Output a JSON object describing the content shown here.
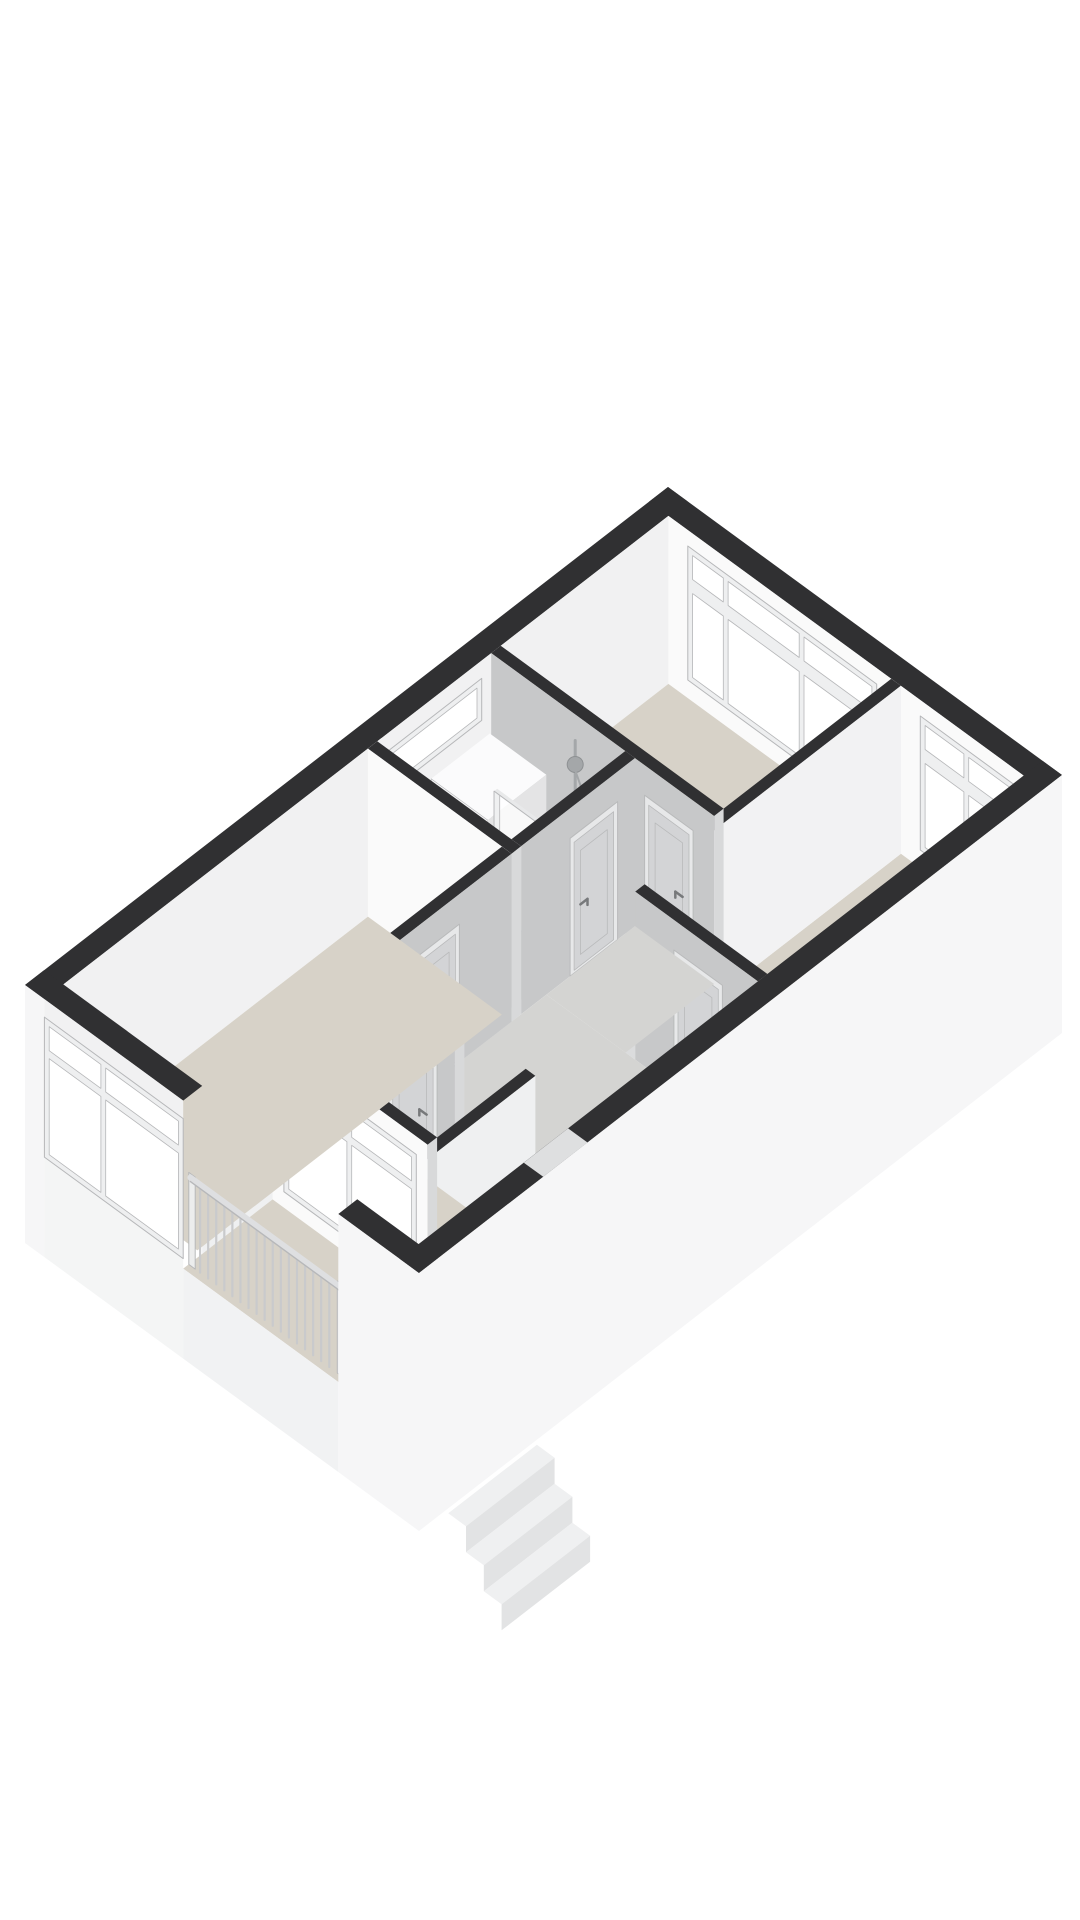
{
  "scene": {
    "type": "isometric-3d-floorplan-render",
    "background": "#ffffff",
    "palette": {
      "wallTop": "#303032",
      "faceWhite": "#fafafa",
      "faceSoft": "#f1f1f2",
      "faceGray": "#c7c8c9",
      "faceDivider": "#f2f2f3",
      "faceCap": "#dbdcdd",
      "faceCapX": "#d8d9da",
      "interiorLight": "#eff0f1",
      "exterior": "#f6f6f7",
      "exteriorWarm": "#f4f5f5",
      "floorBeige": "#d7d2c8",
      "floorHall": "#d4d4d2",
      "floorBath": "#cbcbca",
      "glass": "#ffffff",
      "frame": "#eeeff0",
      "frameStroke": "#b6b7b9",
      "door": "#d3d4d6",
      "doorFrame": "#e7e8e9",
      "doorStroke": "#b9babb",
      "handle": "#77797b",
      "chrome": "#a4a7a9",
      "chromeDark": "#8e9193",
      "railing": "#c9cacc",
      "railTop": "#dedfe1",
      "railStroke": "#b7b8ba",
      "railPanel": "#eceded",
      "washerBody": "#f5f5f6",
      "washerSide": "#e4e4e5",
      "washerTop": "#fbfbfc",
      "washerRing": "#b9babb",
      "washerHub": "#98999b",
      "step": "#fdfdfd",
      "stepSide": "#e8e9ea",
      "extStep": "#eff0f1",
      "extStepSide": "#e2e3e4",
      "notch": "#dedfe0",
      "slabEdge": "#f1f2f3"
    },
    "elements": [
      "ne-facade",
      "nw-facade",
      "se-facade",
      "sw-facade",
      "bedroom-north",
      "bedroom-east",
      "bedroom-south",
      "living-room",
      "bathroom",
      "hallway",
      "corridor",
      "balcony",
      "balcony-railing",
      "staircase",
      "exterior-stairs",
      "washing-machine",
      "shower-set",
      "shower-screen",
      "windows",
      "doors"
    ]
  }
}
